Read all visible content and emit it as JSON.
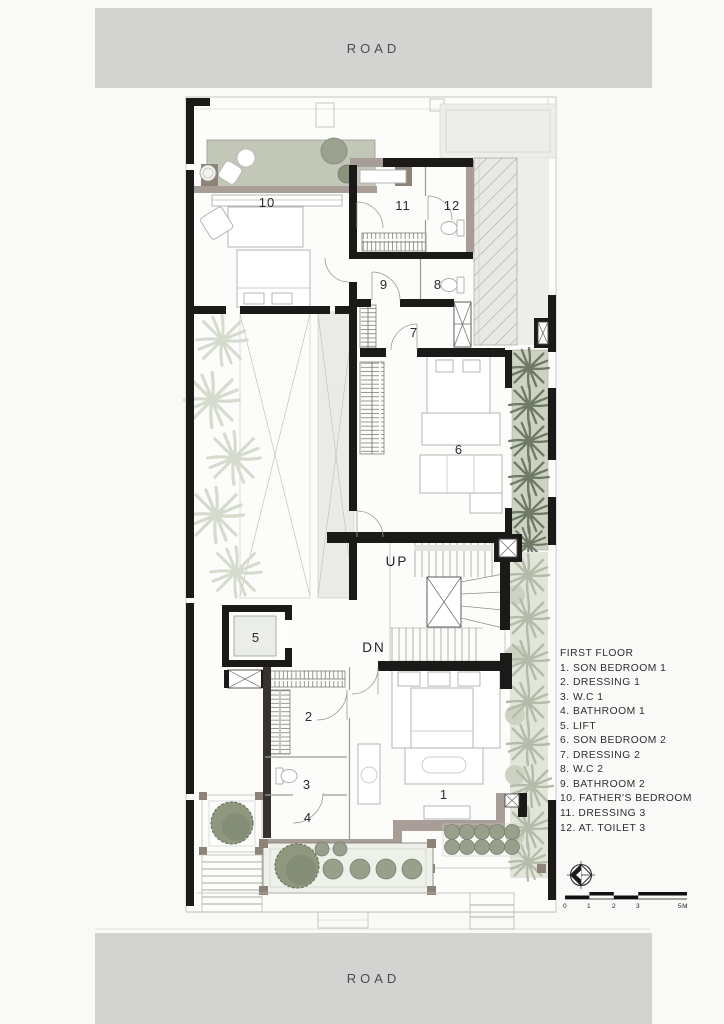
{
  "roads": {
    "top_label": "ROAD",
    "bottom_label": "ROAD"
  },
  "legend": {
    "title": "FIRST FLOOR",
    "items": [
      "1. SON BEDROOM 1",
      "2. DRESSING 1",
      "3. W.C 1",
      "4. BATHROOM 1",
      "5. LIFT",
      "6. SON BEDROOM 2",
      "7. DRESSING 2",
      "8. W.C 2",
      "9. BATHROOM 2",
      "10. FATHER'S BEDROOM",
      "11. DRESSING 3",
      "12. AT. TOILET 3"
    ]
  },
  "plan": {
    "room_numbers": {
      "r1": "1",
      "r2": "2",
      "r3": "3",
      "r4": "4",
      "r5": "5",
      "r6": "6",
      "r7": "7",
      "r8": "8",
      "r9": "9",
      "r10": "10",
      "r11": "11",
      "r12": "12"
    },
    "stair_labels": {
      "up": "UP",
      "down": "DN"
    }
  },
  "scale_bar": {
    "ticks": [
      "0",
      "1",
      "2",
      "3",
      "5M"
    ]
  },
  "colors": {
    "road_bar": "#d3d3d2",
    "wall_black": "#1b1a18",
    "wall_taupe": "#a89e97",
    "planter_green": "#cdd2c3",
    "palm_dark": "#6e7a65",
    "tree_green": "#8f977e",
    "glass": "#e8e8e5",
    "text": "#2d2d2d"
  }
}
